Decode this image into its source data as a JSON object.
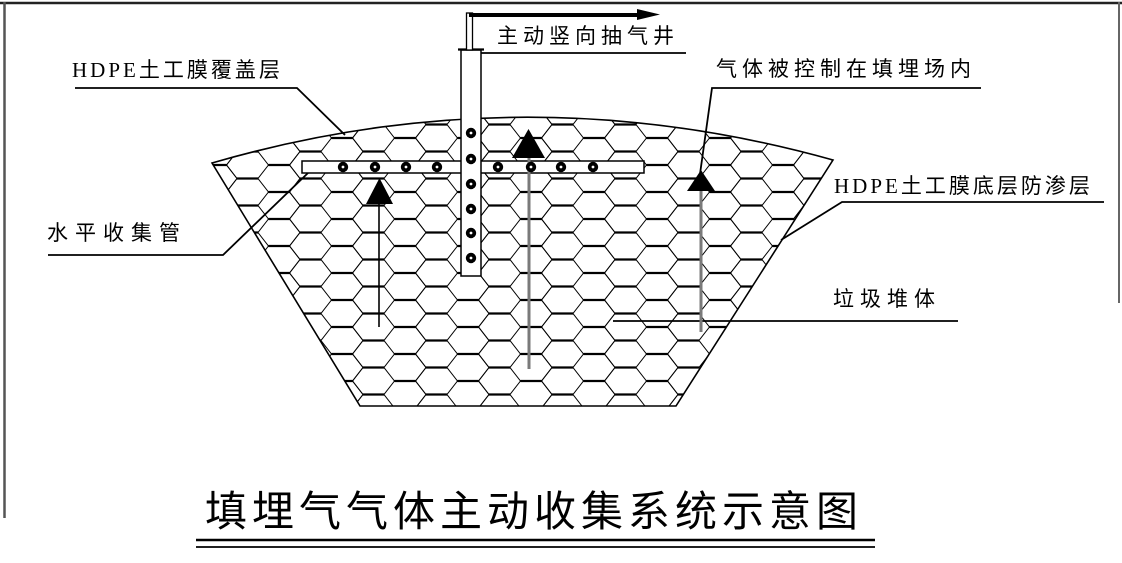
{
  "figure": {
    "title": "填埋气气体主动收集系统示意图",
    "labels": {
      "cover_layer": "HDPE土工膜覆盖层",
      "extraction_well": "主动竖向抽气井",
      "gas_controlled": "气体被控制在填埋场内",
      "bottom_liner": "HDPE土工膜底层防渗层",
      "horizontal_pipe": "水平收集管",
      "waste_body": "垃圾堆体"
    },
    "icons": {
      "gas_flow_arrow": "up-arrow",
      "extraction_flow_arrow": "right-arrow"
    },
    "colors": {
      "line_black": "#000000",
      "arrow_shaft_gray": "#7a7a7a",
      "frame_gray": "#555555",
      "background": "#ffffff"
    }
  }
}
